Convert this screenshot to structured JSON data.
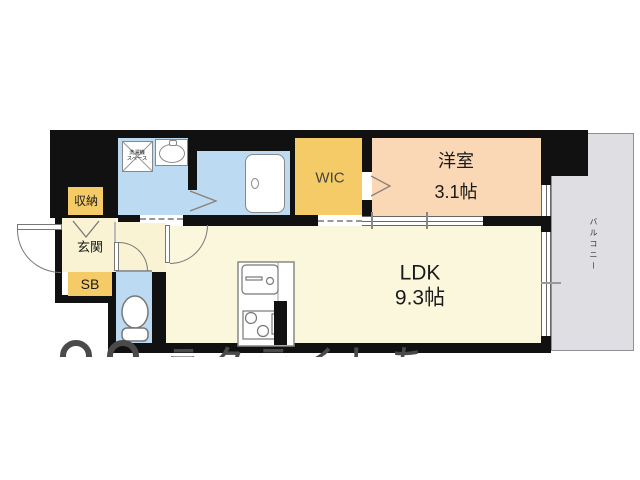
{
  "floorplan": {
    "rooms": {
      "western_room": {
        "name": "洋室",
        "size": "3.1帖"
      },
      "ldk": {
        "name": "LDK",
        "size": "9.3帖"
      },
      "wic": {
        "label": "WIC"
      },
      "entrance": {
        "label": "玄関"
      },
      "storage": {
        "label": "収納"
      },
      "shoe_box": {
        "label": "SB"
      },
      "balcony": {
        "label": "バルコニー"
      },
      "washer_space": {
        "line1": "洗濯機",
        "line2": "スペース"
      }
    },
    "watermark": {
      "text": "ラクテイしち"
    },
    "colors": {
      "wall": "#111111",
      "ldk_floor": "#FBF7DC",
      "entrance_floor": "#FAF3D3",
      "closet_orange": "#F4CB66",
      "wet_area_blue": "#BCDAF2",
      "western_room_peach": "#FAD8B6",
      "balcony_gray": "#DEDEE3",
      "watermark_gray": "#4A4A4A"
    }
  }
}
